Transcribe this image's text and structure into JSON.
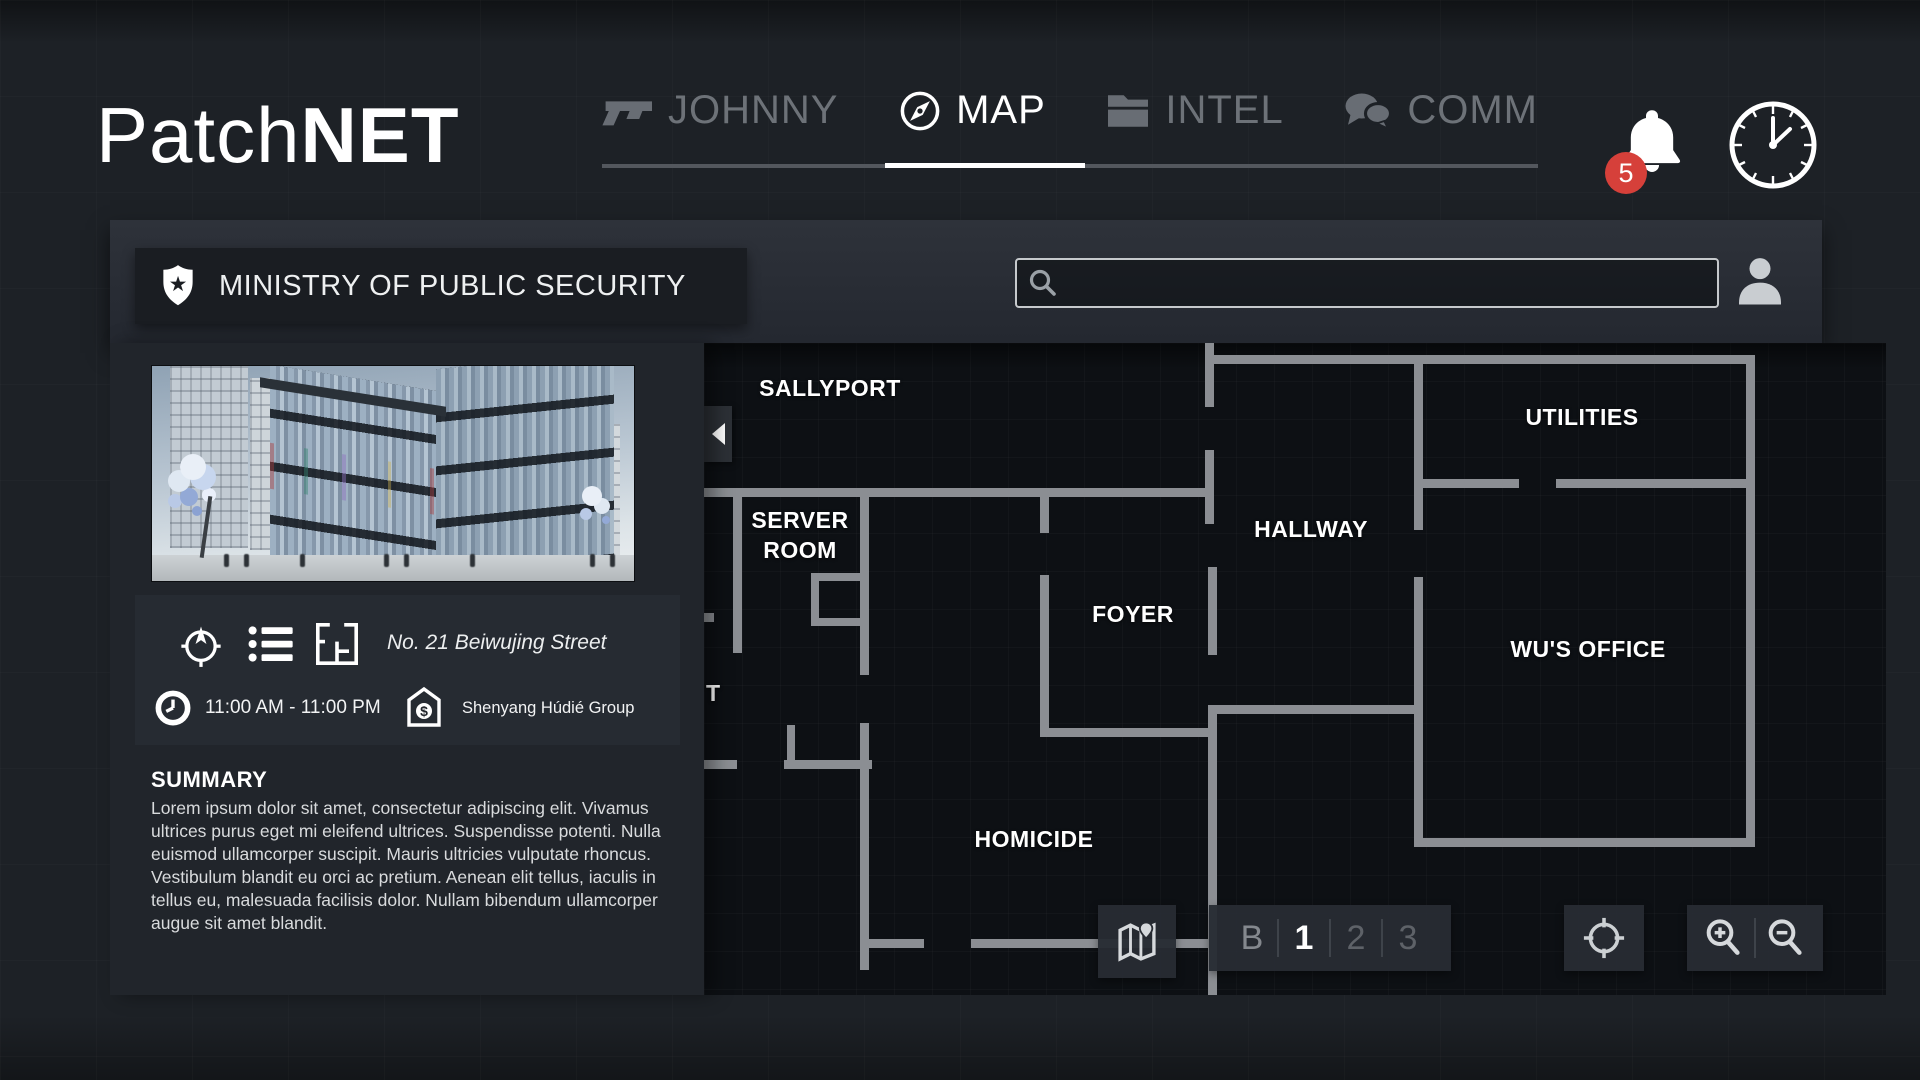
{
  "app": {
    "brand_light": "Patch",
    "brand_bold": "NET",
    "notification_count": "5"
  },
  "nav": {
    "tabs": [
      {
        "label": "JOHNNY",
        "icon": "gun-icon",
        "active": false
      },
      {
        "label": "MAP",
        "icon": "compass-icon",
        "active": true
      },
      {
        "label": "INTEL",
        "icon": "folder-icon",
        "active": false
      },
      {
        "label": "COMM",
        "icon": "chat-icon",
        "active": false
      }
    ]
  },
  "header": {
    "title": "MINISTRY OF PUBLIC SECURITY",
    "title_icon": "police-badge-icon",
    "search_value": "",
    "search_placeholder": ""
  },
  "location_panel": {
    "address": "No. 21 Beiwujing Street",
    "hours": "11:00 AM - 11:00 PM",
    "owner": "Shenyang Húdié Group",
    "summary_title": "SUMMARY",
    "summary_text": "Lorem ipsum dolor sit amet, consectetur adipiscing elit. Vivamus ultrices purus eget mi eleifend ultrices. Suspendisse potenti. Nulla euismod ullamcorper suscipit. Mauris ultricies vulputate rhoncus. Vestibulum blandit eu orci ac pretium. Aenean elit tellus, iaculis in tellus eu, malesuada facilisis dolor. Nullam bibendum ullamcorper augue sit amet blandit."
  },
  "map": {
    "rooms": [
      "SALLYPORT",
      "SERVER ROOM",
      "FOYER",
      "HALLWAY",
      "UTILITIES",
      "WU'S OFFICE",
      "HOMICIDE"
    ],
    "partial_label": "T",
    "floors": [
      "B",
      "1",
      "2",
      "3"
    ],
    "active_floor": "1"
  },
  "colors": {
    "accent_red": "#d6403a",
    "wall": "#8b8e93",
    "tab_inactive": "#6d7278",
    "panel": "#21252b",
    "map_background": "#0d1014"
  },
  "icons": [
    "gun-icon",
    "compass-icon",
    "folder-icon",
    "chat-icon",
    "bell-icon",
    "clock-icon",
    "police-badge-icon",
    "search-icon",
    "user-icon",
    "locate-icon",
    "list-icon",
    "floorplan-icon",
    "small-clock-icon",
    "bank-icon",
    "map-fold-icon",
    "crosshair-icon",
    "zoom-in-icon",
    "zoom-out-icon",
    "collapse-arrow-icon"
  ]
}
